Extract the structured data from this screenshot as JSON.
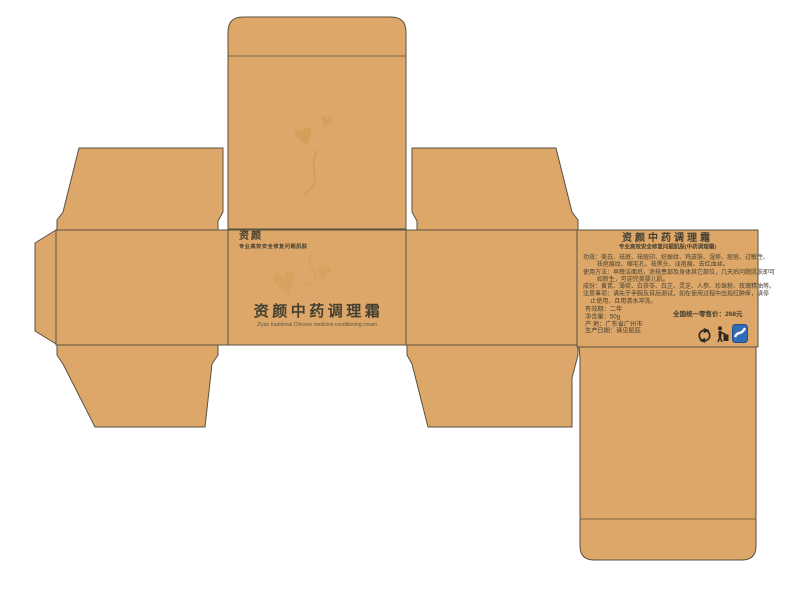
{
  "colors": {
    "panel_fill": "#dca768",
    "panel_outline": "#5a523f",
    "ink": "#453f30",
    "watermark": "#c9913f",
    "cert_blue": "#2e6cb5"
  },
  "front_panel": {
    "brand": "资颜",
    "brand_subtitle": "专业高效安全修复问题肌肤",
    "title": "资颜中药调理霜",
    "title_en": "Ziyan traditional Chinese medicine conditioning cream"
  },
  "back_panel": {
    "title": "资颜中药调理霜",
    "subtitle": "专业高效安全修复问题肌肤(中药调理霜)",
    "body_lines": [
      "功效：美白、祛斑、祛痘印、妊娠纹、鸡皮肤、湿疹、痘痘、过敏性、",
      "祛疤痕纹、缩毛孔、祛黑头、淡痘痕、去红血丝。",
      "使用方法：早晚洁面后，涂抹患部及身体其它部位，几天后问题肌肤即可",
      "如新生，可迎完美婴儿肌。",
      "成份：黄芪、薄荷、白茯苓、白芷、灵芝、人参、珍珠粉、玫瑰精油等。",
      "注意事项：请先于手腕及耳后测试，如在使用过程中出现红肿痒，请停",
      "止使用，且用清水冲洗。"
    ],
    "shelf_life": "有效期：二年",
    "net_content": "净含量：50g",
    "origin": "产  地：广东省广州市",
    "production_date": "生产日期：请见瓶底",
    "price": "全国统一零售价：268元",
    "icons": [
      "recycle-icon",
      "tidyman-icon",
      "cert-icon"
    ]
  },
  "decor": {
    "heart_glyph": "♥"
  }
}
